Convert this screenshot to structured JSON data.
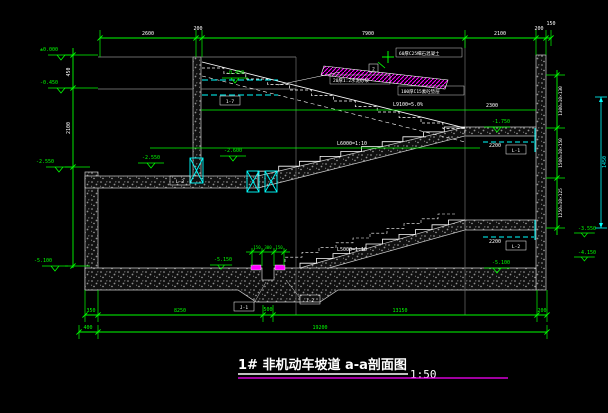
{
  "title": {
    "name": "1# 非机动车坡道  a-a剖面图",
    "scale": "1:50"
  },
  "dims": {
    "top": [
      "2600",
      "200",
      "7900",
      "2100",
      "200",
      "150"
    ],
    "left": [
      "450",
      "2100"
    ],
    "right": [
      "1300=10×130",
      "1500=10×150",
      "1250=10×125"
    ],
    "right_cyan": "1450",
    "bottom_row1": [
      "350",
      "8250",
      "500",
      "13150",
      "200"
    ],
    "bottom_row2": [
      "400",
      "19200"
    ],
    "drain": [
      "150",
      "300",
      "150"
    ],
    "landing_upper_opening": "2200",
    "landing_lower_opening": "2200",
    "level_width": "2300"
  },
  "elevations": {
    "ground": "±0.000",
    "entry": "-0.450",
    "left_mid": "-2.550",
    "slab_a": "-2.550",
    "slab_b": "-2.600",
    "ramp_start": "-0.450",
    "landing_upper": "-1.750",
    "floor_left": "-5.100",
    "floor_right": "-5.100",
    "pit": "-5.150",
    "right_upper": "-3.550",
    "right_lower": "-4.150"
  },
  "slopes": {
    "run1": "L9100=5.0%",
    "run2": "L6000=1:10",
    "run3": "L5000=1:10"
  },
  "notes": {
    "layer_top": "60厚C25细石混凝土",
    "layer_mid": "20厚1:2水泥砂浆",
    "layer_bottom": "100厚C15素砼垫层",
    "detail_no": "2"
  },
  "tags": {
    "opening": "1-7",
    "beam_upper": "L-1",
    "beam_lower": "L-2",
    "beam_slab": "L-3",
    "sump_left": "J-1",
    "sump_right": "J-2"
  },
  "colors": {
    "dim": "#00ff00",
    "line": "#ffffff",
    "hidden": "#00ffff",
    "detail": "#ff00ff",
    "bg": "#000000"
  }
}
